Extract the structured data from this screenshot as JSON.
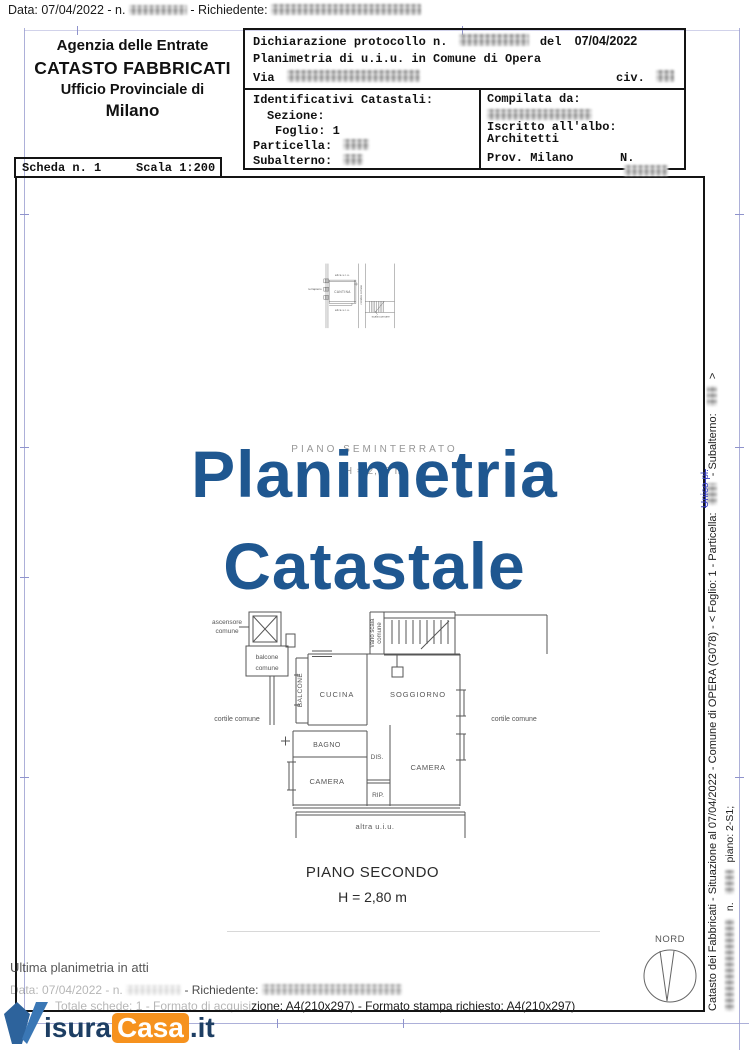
{
  "top_bar": {
    "part1": "Data: 07/04/2022 - n.",
    "part2": "- Richiedente:"
  },
  "agency": {
    "line1": "Agenzia delle Entrate",
    "line2": "CATASTO FABBRICATI",
    "line3": "Ufficio Provinciale di",
    "line4": "Milano"
  },
  "protocol": {
    "dichiarazione": "Dichiarazione protocollo n.",
    "del": "del",
    "date": "07/04/2022",
    "oggetto": "Planimetria di u.i.u. in Comune di Opera",
    "via": "Via",
    "civ": "civ."
  },
  "identificativi": {
    "title": "Identificativi Catastali:",
    "sezione": "Sezione:",
    "foglio": "Foglio: 1",
    "particella": "Particella:",
    "subalterno": "Subalterno:"
  },
  "compilata": {
    "title": "Compilata da:",
    "iscritto": "Iscritto all'albo:",
    "albo": "Architetti",
    "prov": "Prov. Milano",
    "numero": "N."
  },
  "scheda": {
    "numero": "Scheda n. 1",
    "scala": "Scala 1:200"
  },
  "watermark": {
    "line1": "Planimetria",
    "line2": "Catastale",
    "color": "#1f5790"
  },
  "ghost_caption": {
    "line1": "PIANO SEMINTERRATO",
    "line2": "H = 2,56 m"
  },
  "plan_upper": {
    "altra_top": "altra u.i.u.",
    "terrapieno": "terrapieno",
    "cantina": "CANTINA",
    "corridoio": "corridoio comune",
    "altra_bottom": "altra u.i.u.",
    "scala": "scala comune"
  },
  "plan_lower": {
    "ascensore1": "ascensore",
    "ascensore2": "comune",
    "balcone_com1": "balcone",
    "balcone_com2": "comune",
    "balcone": "BALCONE",
    "cucina": "CUCINA",
    "vano_scala1": "vano scala",
    "vano_scala2": "comune",
    "soggiorno": "SOGGIORNO",
    "cortile_sx": "cortile comune",
    "cortile_dx": "cortile comune",
    "bagno": "BAGNO",
    "dis": "DIS.",
    "camera_sx": "CAMERA",
    "rip": "RIP.",
    "camera_dx": "CAMERA",
    "altra": "altra u.i.u."
  },
  "caption": {
    "piano": "PIANO SECONDO",
    "altezza": "H = 2,80 m"
  },
  "compass": {
    "label": "NORD"
  },
  "side_text": {
    "main_1": "Catasto dei Fabbricati - Situazione al 07/04/2022 - Comune di OPERA (G078) - <  Foglio: 1 - Particella:",
    "main_2": "- Subalterno:",
    "main_3": ">",
    "secondary_1": "n.",
    "secondary_2": "piano: 2-S1;",
    "note_blue": "Unico pl."
  },
  "footer": {
    "ultima": "Ultima planimetria in atti",
    "data_part1": "Data: 07/04/2022 - n.",
    "data_part2": "- Richiedente:",
    "formato_part1": "Totale schede: 1 - Formato di acquisi",
    "formato_part2": "zione: A4(210x297)  - Formato stampa richiesto: A4(210x297)"
  },
  "logo": {
    "name_1": "isura",
    "name_2": "Casa",
    "name_3": ".it",
    "navy": "#1d3e63",
    "orange": "#f6921e",
    "mark_blue": "#2d639c"
  }
}
